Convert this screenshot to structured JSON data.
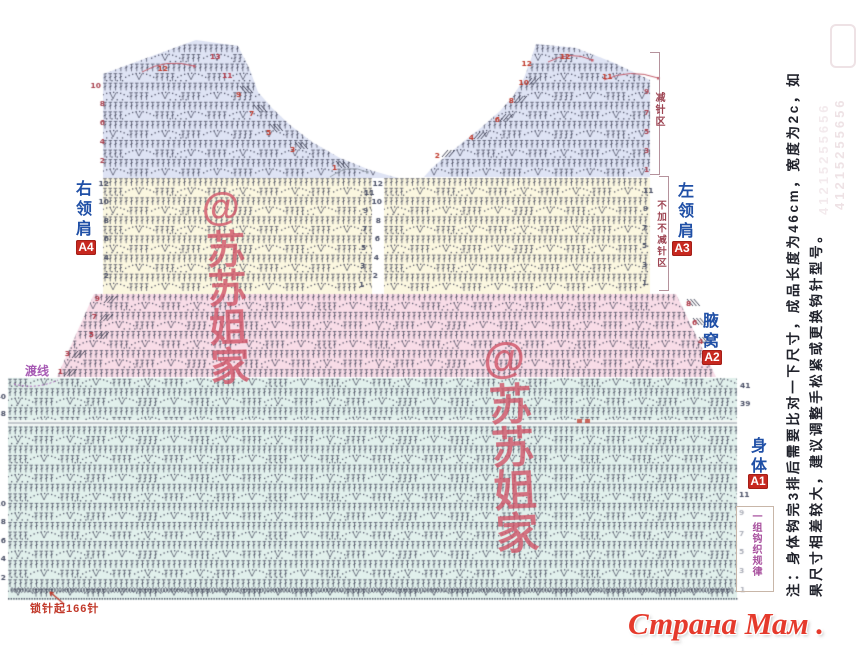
{
  "labels": {
    "right_shoulder": "右领肩",
    "right_shoulder_badge": "A4",
    "left_shoulder": "左领肩",
    "left_shoulder_badge": "A3",
    "armpit": "腋窝",
    "armpit_badge": "A2",
    "body": "身体",
    "body_badge": "A1",
    "decrease_zone": "减针区",
    "no_change_zone": "不加不减针区",
    "one_repeat": "一组钩织规律",
    "crossing_thread": "渡线",
    "foundation": "锁针起166针"
  },
  "note": {
    "line1": "注：身体钩完3排后需要比对一下尺寸，成品长度为46cm，宽度为2c，如",
    "line2": "果尺寸相差较大，建议调整手松紧或更换钩针型号。"
  },
  "watermark": {
    "shop": "@苏苏姐家",
    "faded_contact": "41215255656"
  },
  "logo": {
    "text": "Страна Мам . ру"
  },
  "diagram": {
    "canvas": {
      "w": 860,
      "h": 655
    },
    "stitch_color": "rgba(56,58,80,0.82)",
    "row_y0": 44,
    "row_h": 9.55,
    "sections": [
      {
        "id": "shoulder-right-A4",
        "fill": "#dee3f4",
        "poly": [
          [
            103,
            74
          ],
          [
            196,
            40
          ],
          [
            238,
            46
          ],
          [
            250,
            70
          ],
          [
            258,
            92
          ],
          [
            272,
            108
          ],
          [
            290,
            125
          ],
          [
            312,
            142
          ],
          [
            340,
            158
          ],
          [
            370,
            170
          ],
          [
            398,
            178
          ],
          [
            103,
            178
          ]
        ]
      },
      {
        "id": "shoulder-left-A3",
        "fill": "#dee3f4",
        "poly": [
          [
            536,
            44
          ],
          [
            576,
            48
          ],
          [
            612,
            62
          ],
          [
            650,
            80
          ],
          [
            650,
            177
          ],
          [
            424,
            177
          ],
          [
            432,
            168
          ],
          [
            446,
            156
          ],
          [
            462,
            143
          ],
          [
            482,
            127
          ],
          [
            500,
            111
          ],
          [
            514,
            95
          ],
          [
            524,
            78
          ],
          [
            530,
            62
          ]
        ]
      },
      {
        "id": "yoke-left",
        "fill": "#fbf7e0",
        "poly": [
          [
            103,
            178
          ],
          [
            372,
            178
          ],
          [
            372,
            294
          ],
          [
            103,
            294
          ]
        ]
      },
      {
        "id": "yoke-right",
        "fill": "#fbf7e0",
        "poly": [
          [
            384,
            178
          ],
          [
            650,
            178
          ],
          [
            650,
            294
          ],
          [
            384,
            294
          ]
        ]
      },
      {
        "id": "underarm-A2",
        "fill": "#f8dce7",
        "poly": [
          [
            94,
            294
          ],
          [
            676,
            294
          ],
          [
            716,
            377
          ],
          [
            57,
            377
          ]
        ]
      },
      {
        "id": "body-A1",
        "fill": "#e1f0ec",
        "poly": [
          [
            8,
            378
          ],
          [
            737,
            378
          ],
          [
            737,
            600
          ],
          [
            8,
            600
          ]
        ]
      }
    ],
    "break_line": {
      "y": 423,
      "x1": 8,
      "x2": 737,
      "color": "#939ba5"
    },
    "oval_row": {
      "y": 590,
      "x1": 12,
      "x2": 734
    },
    "dot_row": {
      "y": 598,
      "x1": 8,
      "x2": 737
    },
    "numbers": [
      [
        "13",
        210,
        59,
        "#b53b49",
        "l"
      ],
      [
        "12",
        168,
        71,
        "#c0392b",
        "r"
      ],
      [
        "11",
        222,
        78,
        "#b53b49",
        "l"
      ],
      [
        "10",
        101,
        88,
        "#a8404e",
        "r"
      ],
      [
        "9",
        236,
        97,
        "#c0392b",
        "l"
      ],
      [
        "8",
        105,
        106,
        "#a8404e",
        "r"
      ],
      [
        "7",
        249,
        116,
        "#c0392b",
        "l"
      ],
      [
        "6",
        105,
        125,
        "#a8404e",
        "r"
      ],
      [
        "5",
        266,
        135,
        "#c0392b",
        "l"
      ],
      [
        "4",
        105,
        144,
        "#a8404e",
        "r"
      ],
      [
        "3",
        290,
        152,
        "#c0392b",
        "l"
      ],
      [
        "2",
        105,
        163,
        "#a8404e",
        "r"
      ],
      [
        "1",
        332,
        170,
        "#c0392b",
        "l"
      ],
      [
        "12",
        560,
        59,
        "#c0392b",
        "l"
      ],
      [
        "12",
        532,
        66,
        "#c0392b",
        "r"
      ],
      [
        "11",
        602,
        79,
        "#c0392b",
        "l"
      ],
      [
        "10",
        529,
        85,
        "#c0392b",
        "r"
      ],
      [
        "9",
        644,
        94,
        "#a8404e",
        "l"
      ],
      [
        "8",
        514,
        103,
        "#c0392b",
        "r"
      ],
      [
        "7",
        644,
        115,
        "#a8404e",
        "l"
      ],
      [
        "6",
        500,
        122,
        "#c0392b",
        "r"
      ],
      [
        "5",
        644,
        134,
        "#a8404e",
        "l"
      ],
      [
        "4",
        474,
        140,
        "#c0392b",
        "r"
      ],
      [
        "3",
        644,
        153,
        "#a8404e",
        "l"
      ],
      [
        "2",
        440,
        158,
        "#c0392b",
        "r"
      ],
      [
        "1",
        644,
        172,
        "#a8404e",
        "l"
      ],
      [
        "12",
        109,
        186,
        "#4a5066",
        "r"
      ],
      [
        "10",
        109,
        204,
        "#4a5066",
        "r"
      ],
      [
        "8",
        109,
        223,
        "#4a5066",
        "r"
      ],
      [
        "6",
        109,
        241,
        "#4a5066",
        "r"
      ],
      [
        "4",
        109,
        260,
        "#4a5066",
        "r"
      ],
      [
        "2",
        109,
        278,
        "#4a5066",
        "r"
      ],
      [
        "11",
        364,
        195,
        "#4a5066",
        "l"
      ],
      [
        "9",
        363,
        213,
        "#4a5066",
        "l"
      ],
      [
        "7",
        362,
        231,
        "#4a5066",
        "l"
      ],
      [
        "5",
        361,
        250,
        "#4a5066",
        "l"
      ],
      [
        "3",
        360,
        268,
        "#4a5066",
        "l"
      ],
      [
        "1",
        359,
        287,
        "#4a5066",
        "l"
      ],
      [
        "12",
        383,
        186,
        "#4a5066",
        "r"
      ],
      [
        "10",
        382,
        204,
        "#4a5066",
        "r"
      ],
      [
        "8",
        381,
        223,
        "#4a5066",
        "r"
      ],
      [
        "6",
        380,
        241,
        "#4a5066",
        "r"
      ],
      [
        "4",
        379,
        260,
        "#4a5066",
        "r"
      ],
      [
        "2",
        378,
        278,
        "#4a5066",
        "r"
      ],
      [
        "11",
        643,
        193,
        "#4a5066",
        "l"
      ],
      [
        "9",
        643,
        211,
        "#4a5066",
        "l"
      ],
      [
        "7",
        642,
        230,
        "#4a5066",
        "l"
      ],
      [
        "5",
        642,
        248,
        "#4a5066",
        "l"
      ],
      [
        "3",
        642,
        267,
        "#4a5066",
        "l"
      ],
      [
        "1",
        642,
        285,
        "#4a5066",
        "l"
      ],
      [
        "9",
        100,
        301,
        "#b03a48",
        "r"
      ],
      [
        "7",
        97,
        319,
        "#b03a48",
        "r"
      ],
      [
        "5",
        94,
        337,
        "#b03a48",
        "r"
      ],
      [
        "3",
        70,
        356,
        "#b03a48",
        "r"
      ],
      [
        "1",
        63,
        374,
        "#b03a48",
        "r"
      ],
      [
        "8",
        686,
        306,
        "#b03a48",
        "l"
      ],
      [
        "6",
        692,
        325,
        "#b03a48",
        "l"
      ],
      [
        "4",
        698,
        344,
        "#b03a48",
        "l"
      ],
      [
        "2",
        705,
        362,
        "#b03a48",
        "l"
      ],
      [
        "40",
        6,
        399,
        "#4a5066",
        "r"
      ],
      [
        "38",
        6,
        416,
        "#4a5066",
        "r"
      ],
      [
        "10",
        6,
        506,
        "#4a5066",
        "r"
      ],
      [
        "8",
        6,
        524,
        "#4a5066",
        "r"
      ],
      [
        "6",
        6,
        543,
        "#4a5066",
        "r"
      ],
      [
        "4",
        6,
        561,
        "#4a5066",
        "r"
      ],
      [
        "2",
        6,
        580,
        "#4a5066",
        "r"
      ],
      [
        "41",
        740,
        388,
        "#4a5066",
        "l"
      ],
      [
        "39",
        740,
        406,
        "#4a5066",
        "l"
      ],
      [
        "11",
        739,
        497,
        "#4a5066",
        "l"
      ],
      [
        "9",
        739,
        515,
        "#4a5066",
        "l"
      ],
      [
        "7",
        739,
        536,
        "#4a5066",
        "l"
      ],
      [
        "5",
        739,
        554,
        "#4a5066",
        "l"
      ],
      [
        "3",
        739,
        573,
        "#4a5066",
        "l"
      ],
      [
        "1",
        740,
        592,
        "#4a5066",
        "l"
      ]
    ],
    "diag_marks": [
      [
        240,
        86,
        1
      ],
      [
        254,
        105,
        1
      ],
      [
        270,
        124,
        1
      ],
      [
        295,
        142,
        1
      ],
      [
        336,
        161,
        1
      ],
      [
        526,
        78,
        -1
      ],
      [
        514,
        96,
        -1
      ],
      [
        500,
        114,
        -1
      ],
      [
        474,
        132,
        -1
      ],
      [
        442,
        150,
        -1
      ],
      [
        687,
        299,
        1
      ],
      [
        693,
        318,
        1
      ],
      [
        699,
        337,
        1
      ],
      [
        706,
        356,
        1
      ],
      [
        104,
        296,
        -1
      ],
      [
        100,
        314,
        -1
      ],
      [
        96,
        332,
        -1
      ],
      [
        72,
        351,
        -1
      ],
      [
        64,
        369,
        -1
      ]
    ],
    "arcs": [
      [
        142,
        72,
        166,
        58,
        194,
        66,
        "#c4606e"
      ],
      [
        548,
        62,
        570,
        50,
        592,
        60,
        "#c4606e"
      ],
      [
        604,
        80,
        630,
        68,
        658,
        78,
        "#c4606e"
      ],
      [
        330,
        177,
        348,
        163,
        367,
        172,
        "#98a0ac"
      ]
    ],
    "foundation_arrow": [
      64,
      604,
      50,
      592
    ],
    "crossing_arc": [
      14,
      384,
      36,
      390,
      58,
      380
    ],
    "tiny_marks": [
      [
        577,
        423
      ],
      [
        585,
        423
      ]
    ]
  }
}
